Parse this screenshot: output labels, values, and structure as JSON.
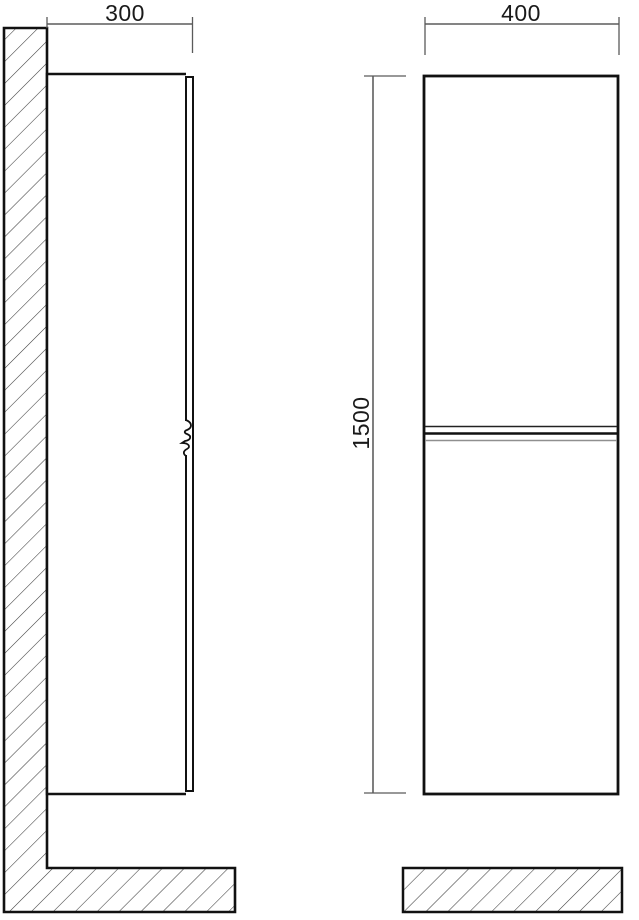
{
  "diagram": {
    "type": "furniture-technical-drawing",
    "subject": "wall-mounted tall cabinet, side view and front view with section hatching",
    "dimension_labels": {
      "depth": "300",
      "width": "400",
      "height": "1500"
    },
    "colors": {
      "outline": "#111111",
      "dimension_line": "#3a3a3a",
      "extension_line": "#5a5a5a",
      "hatch_line": "#3d3d3d",
      "door_gap_shadow": "#8f8f8f",
      "background": "#ffffff",
      "text": "#1a1a1a"
    }
  }
}
